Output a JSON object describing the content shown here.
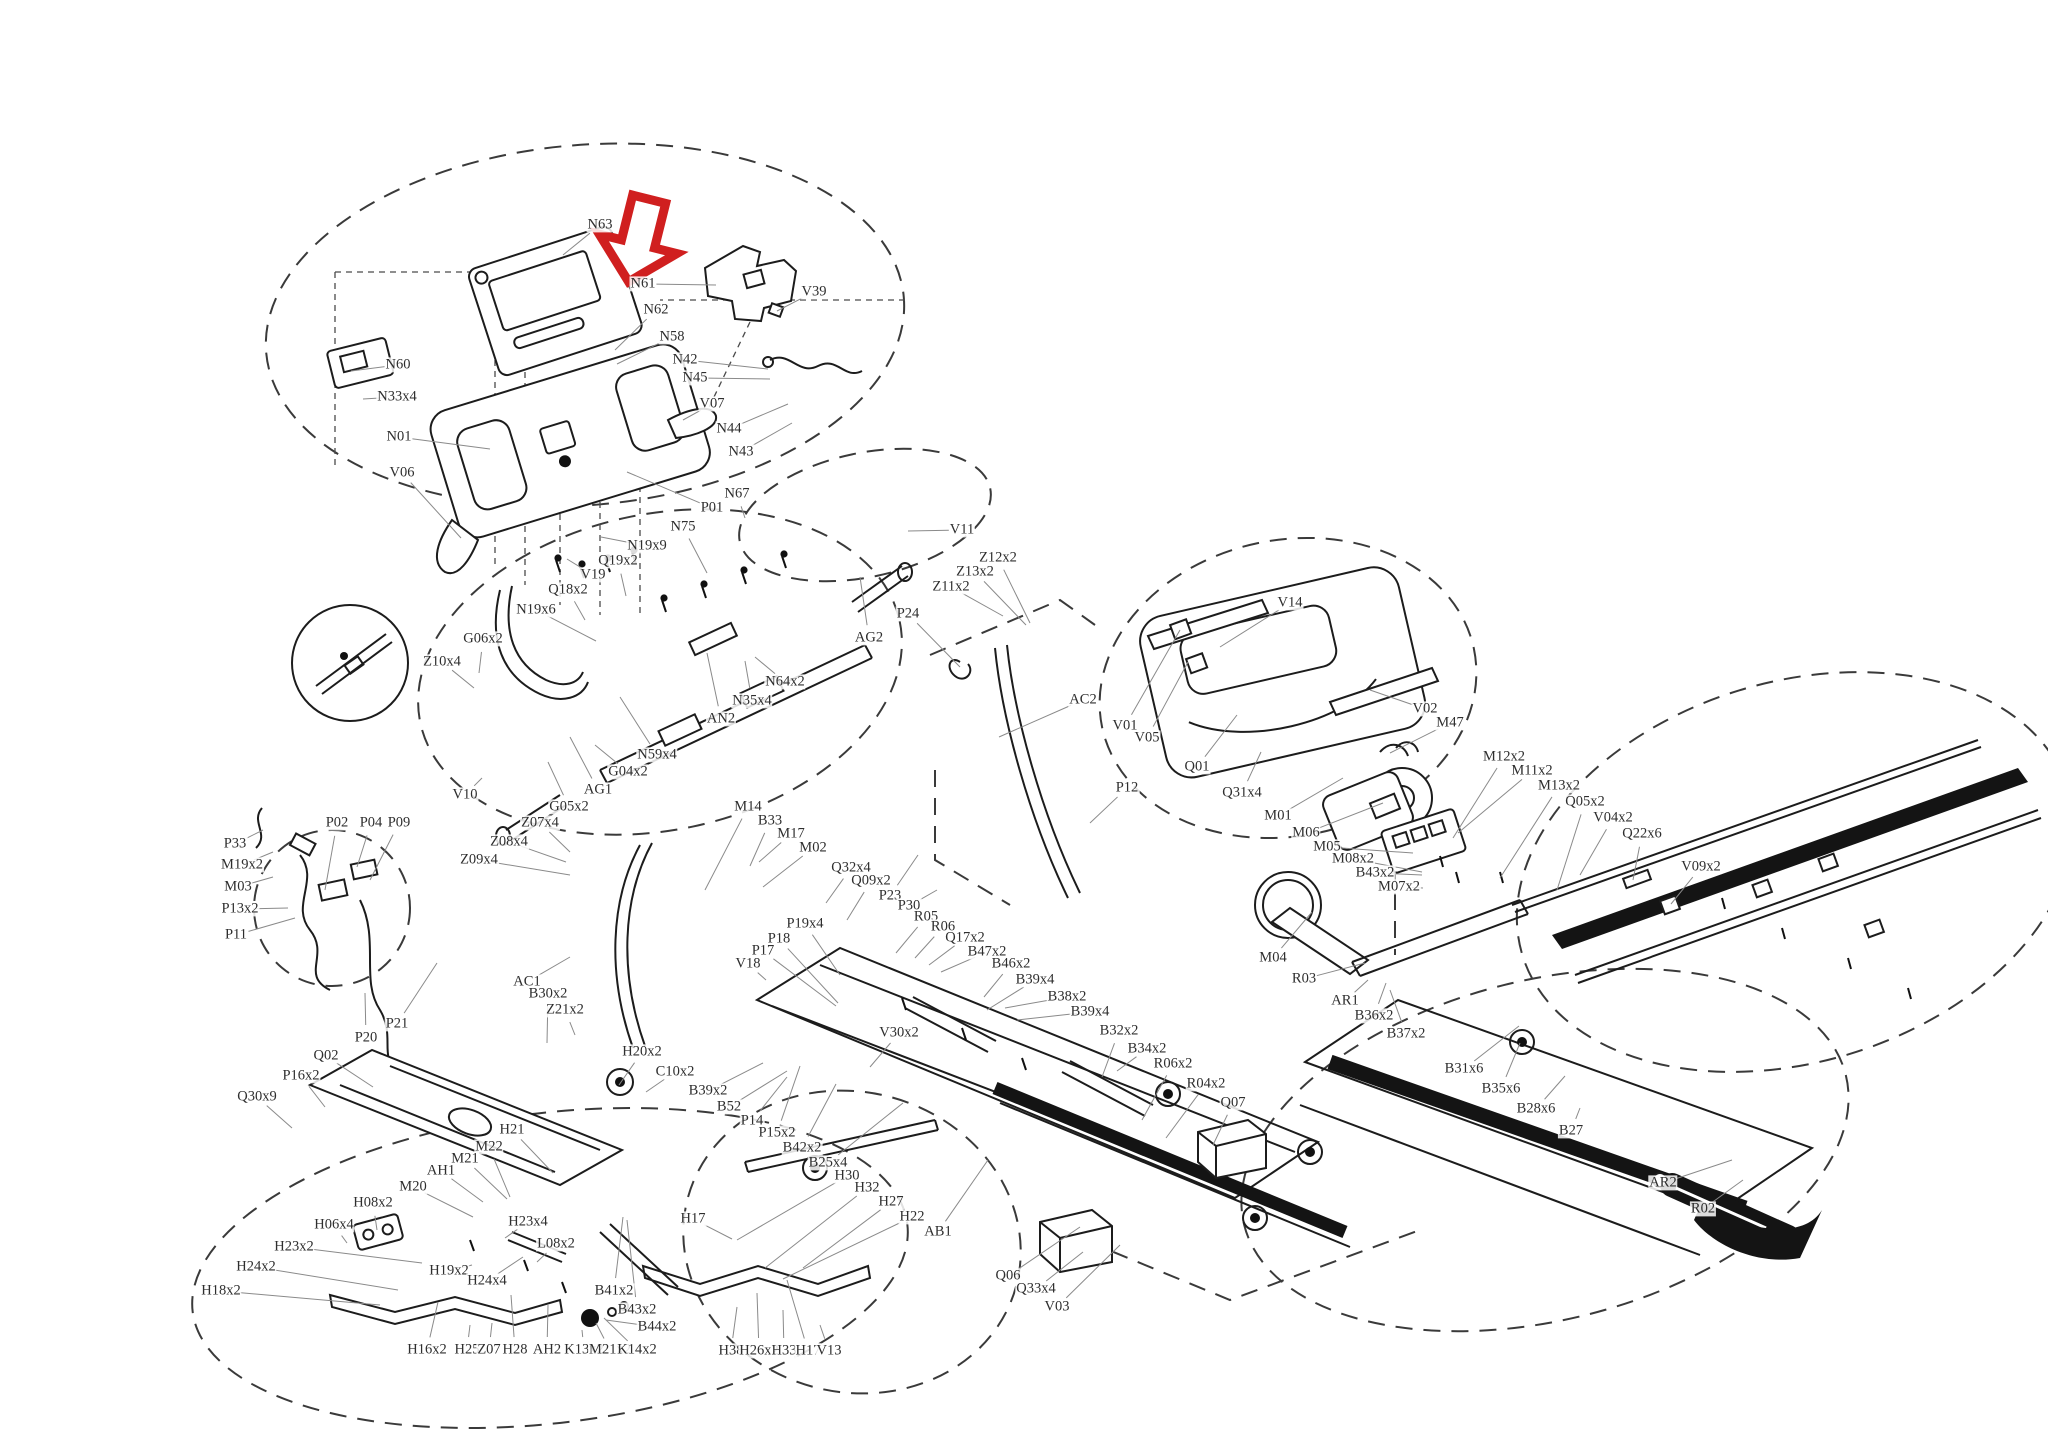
{
  "document": {
    "type": "exploded-parts-diagram",
    "subject": "treadmill assembly parts diagram",
    "highlighted_part": "N61"
  },
  "colors": {
    "arrow": "#d01f1f",
    "line": "#1c1c1c",
    "leader": "#8a8a8a",
    "label_text": "#2e2e2e",
    "background": "#ffffff"
  },
  "diagram": {
    "labels": [
      [
        "N63",
        600,
        225,
        563,
        255
      ],
      [
        "N61",
        643,
        284,
        716,
        285
      ],
      [
        "V39",
        814,
        292,
        777,
        311
      ],
      [
        "N62",
        656,
        310,
        615,
        350
      ],
      [
        "N58",
        672,
        337,
        617,
        364
      ],
      [
        "N42",
        685,
        360,
        768,
        369
      ],
      [
        "N45",
        695,
        378,
        770,
        379
      ],
      [
        "V07",
        712,
        404,
        683,
        420
      ],
      [
        "N44",
        729,
        429,
        788,
        404
      ],
      [
        "N43",
        741,
        452,
        792,
        423
      ],
      [
        "N60",
        398,
        365,
        351,
        371
      ],
      [
        "N33x4",
        397,
        397,
        363,
        399
      ],
      [
        "N01",
        399,
        437,
        490,
        449
      ],
      [
        "V06",
        402,
        473,
        461,
        538
      ],
      [
        "N19x9",
        647,
        546,
        601,
        537
      ],
      [
        "Q19x2",
        618,
        561,
        626,
        596
      ],
      [
        "V19",
        593,
        575,
        567,
        559
      ],
      [
        "Q18x2",
        568,
        590,
        585,
        620
      ],
      [
        "N19x6",
        536,
        610,
        596,
        641
      ],
      [
        "G06x2",
        483,
        639,
        479,
        673
      ],
      [
        "Z10x4",
        442,
        662,
        474,
        688
      ],
      [
        "N75",
        683,
        527,
        707,
        573
      ],
      [
        "P01",
        712,
        508,
        627,
        472
      ],
      [
        "N67",
        737,
        494,
        745,
        518
      ],
      [
        "AG2",
        869,
        638,
        860,
        577
      ],
      [
        "N64x2",
        785,
        682,
        755,
        657
      ],
      [
        "N35x4",
        752,
        701,
        745,
        661
      ],
      [
        "AN2",
        721,
        719,
        707,
        653
      ],
      [
        "N59x4",
        657,
        755,
        620,
        697
      ],
      [
        "G04x2",
        628,
        772,
        595,
        745
      ],
      [
        "AG1",
        598,
        790,
        570,
        737
      ],
      [
        "G05x2",
        569,
        807,
        548,
        762
      ],
      [
        "V10",
        465,
        795,
        482,
        778
      ],
      [
        "M14",
        748,
        807,
        705,
        890
      ],
      [
        "B33",
        770,
        821,
        750,
        866
      ],
      [
        "M17",
        791,
        834,
        759,
        862
      ],
      [
        "M02",
        813,
        848,
        763,
        887
      ],
      [
        "Z07x4",
        540,
        823,
        570,
        852
      ],
      [
        "Z08x4",
        509,
        842,
        566,
        862
      ],
      [
        "Z09x4",
        479,
        860,
        570,
        875
      ],
      [
        "AC1",
        527,
        982,
        570,
        957
      ],
      [
        "B30x2",
        548,
        994,
        547,
        1043
      ],
      [
        "Z21x2",
        565,
        1010,
        575,
        1035
      ],
      [
        "H20x2",
        642,
        1052,
        619,
        1085
      ],
      [
        "C10x2",
        675,
        1072,
        646,
        1092
      ],
      [
        "P33",
        235,
        844,
        263,
        830
      ],
      [
        "M19x2",
        242,
        865,
        273,
        852
      ],
      [
        "M03",
        238,
        887,
        273,
        877
      ],
      [
        "P13x2",
        240,
        909,
        288,
        908
      ],
      [
        "P11",
        236,
        935,
        295,
        918
      ],
      [
        "P02",
        337,
        823,
        325,
        890
      ],
      [
        "P04",
        371,
        823,
        357,
        867
      ],
      [
        "P09",
        399,
        823,
        370,
        880
      ],
      [
        "P20",
        366,
        1038,
        365,
        993
      ],
      [
        "P21",
        397,
        1024,
        437,
        963
      ],
      [
        "Q02",
        326,
        1056,
        373,
        1087
      ],
      [
        "P16x2",
        301,
        1076,
        325,
        1107
      ],
      [
        "Q30x9",
        257,
        1097,
        292,
        1128
      ],
      [
        "Q32x4",
        851,
        868,
        826,
        903
      ],
      [
        "Q09x2",
        871,
        881,
        847,
        920
      ],
      [
        "P23",
        890,
        896,
        918,
        855
      ],
      [
        "P30",
        909,
        906,
        937,
        890
      ],
      [
        "R05",
        926,
        917,
        896,
        953
      ],
      [
        "R06",
        943,
        927,
        915,
        958
      ],
      [
        "Q17x2",
        965,
        938,
        929,
        965
      ],
      [
        "B47x2",
        987,
        952,
        941,
        972
      ],
      [
        "B46x2",
        1011,
        964,
        984,
        997
      ],
      [
        "B39x4",
        1035,
        980,
        987,
        1010
      ],
      [
        "B38x2",
        1067,
        997,
        1005,
        1008
      ],
      [
        "B39x4",
        1090,
        1012,
        1017,
        1020
      ],
      [
        "P19x4",
        805,
        924,
        840,
        975
      ],
      [
        "P18",
        779,
        939,
        838,
        1003
      ],
      [
        "P17",
        763,
        951,
        836,
        1006
      ],
      [
        "V18",
        748,
        964,
        766,
        980
      ],
      [
        "V30x2",
        899,
        1033,
        870,
        1067
      ],
      [
        "B32x2",
        1119,
        1031,
        1102,
        1077
      ],
      [
        "B34x2",
        1147,
        1049,
        1117,
        1071
      ],
      [
        "R06x2",
        1173,
        1064,
        1142,
        1120
      ],
      [
        "R04x2",
        1206,
        1084,
        1166,
        1138
      ],
      [
        "Q07",
        1233,
        1103,
        1213,
        1145
      ],
      [
        "B39x2",
        708,
        1091,
        763,
        1063
      ],
      [
        "B52",
        729,
        1107,
        787,
        1071
      ],
      [
        "P14",
        752,
        1121,
        787,
        1077
      ],
      [
        "P15x2",
        777,
        1133,
        800,
        1066
      ],
      [
        "B42x2",
        802,
        1148,
        836,
        1084
      ],
      [
        "B25x4",
        828,
        1163,
        903,
        1103
      ],
      [
        "H30",
        847,
        1176,
        737,
        1240
      ],
      [
        "H32",
        867,
        1188,
        765,
        1268
      ],
      [
        "H27",
        891,
        1202,
        803,
        1268
      ],
      [
        "H22",
        912,
        1217,
        783,
        1279
      ],
      [
        "AB1",
        938,
        1232,
        988,
        1160
      ],
      [
        "H17",
        693,
        1219,
        732,
        1239
      ],
      [
        "H38",
        731,
        1351,
        737,
        1307
      ],
      [
        "H26x2",
        759,
        1351,
        757,
        1293
      ],
      [
        "H33",
        784,
        1351,
        783,
        1310
      ],
      [
        "H17",
        808,
        1351,
        787,
        1280
      ],
      [
        "V13",
        829,
        1351,
        820,
        1325
      ],
      [
        "Q06",
        1008,
        1276,
        1080,
        1227
      ],
      [
        "Q33x4",
        1036,
        1289,
        1083,
        1252
      ],
      [
        "V03",
        1057,
        1307,
        1120,
        1245
      ],
      [
        "H21",
        512,
        1130,
        553,
        1173
      ],
      [
        "M22",
        489,
        1147,
        510,
        1197
      ],
      [
        "M21",
        465,
        1159,
        507,
        1199
      ],
      [
        "AH1",
        441,
        1171,
        483,
        1202
      ],
      [
        "M20",
        413,
        1187,
        473,
        1217
      ],
      [
        "H08x2",
        373,
        1203,
        377,
        1230
      ],
      [
        "H06x4",
        334,
        1225,
        347,
        1243
      ],
      [
        "H23x2",
        294,
        1247,
        422,
        1263
      ],
      [
        "H24x2",
        256,
        1267,
        398,
        1290
      ],
      [
        "H18x2",
        221,
        1291,
        380,
        1305
      ],
      [
        "H23x4",
        528,
        1222,
        505,
        1238
      ],
      [
        "L08x2",
        556,
        1244,
        537,
        1262
      ],
      [
        "H19x2",
        449,
        1271,
        472,
        1265
      ],
      [
        "H24x4",
        487,
        1281,
        523,
        1257
      ],
      [
        "B41x2",
        614,
        1291,
        623,
        1217
      ],
      [
        "B43x2",
        637,
        1310,
        627,
        1220
      ],
      [
        "B44x2",
        657,
        1327,
        606,
        1320
      ],
      [
        "H16x2",
        427,
        1350,
        438,
        1302
      ],
      [
        "H25",
        467,
        1350,
        470,
        1325
      ],
      [
        "Z07",
        489,
        1350,
        492,
        1323
      ],
      [
        "H28",
        515,
        1350,
        511,
        1295
      ],
      [
        "AH2",
        547,
        1350,
        548,
        1305
      ],
      [
        "K13x2",
        584,
        1350,
        582,
        1330
      ],
      [
        "M21x2",
        610,
        1350,
        596,
        1323
      ],
      [
        "K14x2",
        637,
        1350,
        604,
        1318
      ],
      [
        "V14",
        1290,
        603,
        1220,
        647
      ],
      [
        "V01",
        1125,
        726,
        1180,
        630
      ],
      [
        "V05",
        1147,
        738,
        1188,
        662
      ],
      [
        "Q01",
        1197,
        767,
        1237,
        715
      ],
      [
        "Q31x4",
        1242,
        793,
        1261,
        752
      ],
      [
        "V02",
        1425,
        709,
        1370,
        690
      ],
      [
        "M47",
        1450,
        723,
        1390,
        753
      ],
      [
        "M01",
        1278,
        816,
        1343,
        778
      ],
      [
        "M06",
        1306,
        833,
        1383,
        803
      ],
      [
        "P12",
        1127,
        788,
        1090,
        823
      ],
      [
        "V11",
        962,
        530,
        908,
        531
      ],
      [
        "Z12x2",
        998,
        558,
        1030,
        623
      ],
      [
        "Z13x2",
        975,
        572,
        1026,
        625
      ],
      [
        "Z11x2",
        951,
        587,
        1003,
        616
      ],
      [
        "P24",
        908,
        614,
        960,
        667
      ],
      [
        "AC2",
        1083,
        700,
        999,
        737
      ],
      [
        "M12x2",
        1504,
        757,
        1453,
        838
      ],
      [
        "M11x2",
        1532,
        771,
        1458,
        833
      ],
      [
        "M13x2",
        1559,
        786,
        1500,
        878
      ],
      [
        "Q05x2",
        1585,
        802,
        1557,
        890
      ],
      [
        "V04x2",
        1613,
        818,
        1580,
        875
      ],
      [
        "Q22x6",
        1642,
        834,
        1633,
        880
      ],
      [
        "V09x2",
        1701,
        867,
        1671,
        904
      ],
      [
        "M05",
        1327,
        847,
        1413,
        853
      ],
      [
        "M08x2",
        1353,
        859,
        1422,
        872
      ],
      [
        "B43x2",
        1375,
        873,
        1422,
        875
      ],
      [
        "M07x2",
        1399,
        887,
        1423,
        888
      ],
      [
        "M04",
        1273,
        958,
        1312,
        912
      ],
      [
        "R03",
        1304,
        979,
        1365,
        963
      ],
      [
        "AR1",
        1345,
        1001,
        1368,
        980
      ],
      [
        "B36x2",
        1374,
        1016,
        1386,
        983
      ],
      [
        "B37x2",
        1406,
        1034,
        1390,
        990
      ],
      [
        "B31x6",
        1464,
        1069,
        1519,
        1026
      ],
      [
        "B35x6",
        1501,
        1089,
        1520,
        1043
      ],
      [
        "B28x6",
        1536,
        1109,
        1565,
        1076
      ],
      [
        "B27",
        1571,
        1131,
        1580,
        1108
      ],
      [
        "AR2",
        1663,
        1183,
        1732,
        1160
      ],
      [
        "R02",
        1703,
        1209,
        1743,
        1180
      ]
    ]
  }
}
